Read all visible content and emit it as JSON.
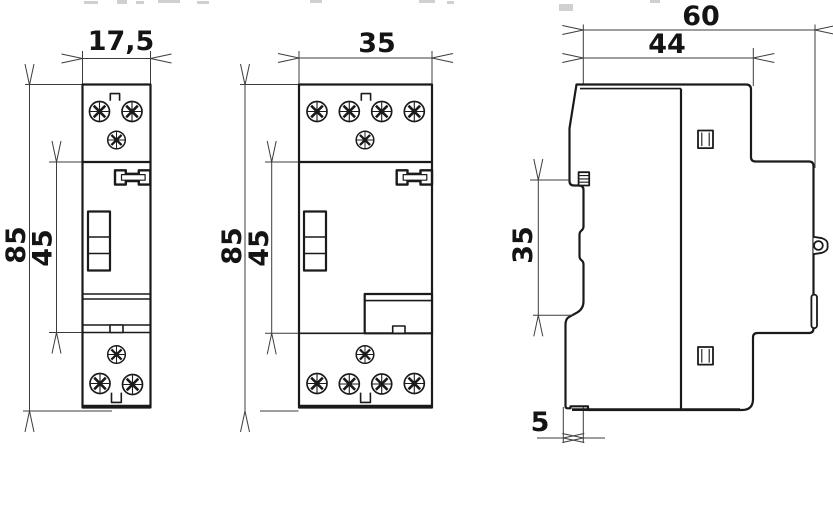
{
  "drawing": {
    "background": "#ffffff",
    "line_color": "#1a1a1a",
    "dimension_color": "#3c3c3c",
    "views": {
      "front_single": {
        "width_label": "17,5",
        "height_label": "85",
        "upper_section_label": "45",
        "top_screws": 3,
        "bottom_screws": 3
      },
      "front_double": {
        "width_label": "35",
        "height_label": "85",
        "upper_section_label": "45",
        "top_screws": 5,
        "bottom_screws": 5
      },
      "side": {
        "overall_depth_label": "60",
        "body_depth_label": "44",
        "mid_height_label": "35",
        "foot_offset_label": "5"
      }
    }
  }
}
